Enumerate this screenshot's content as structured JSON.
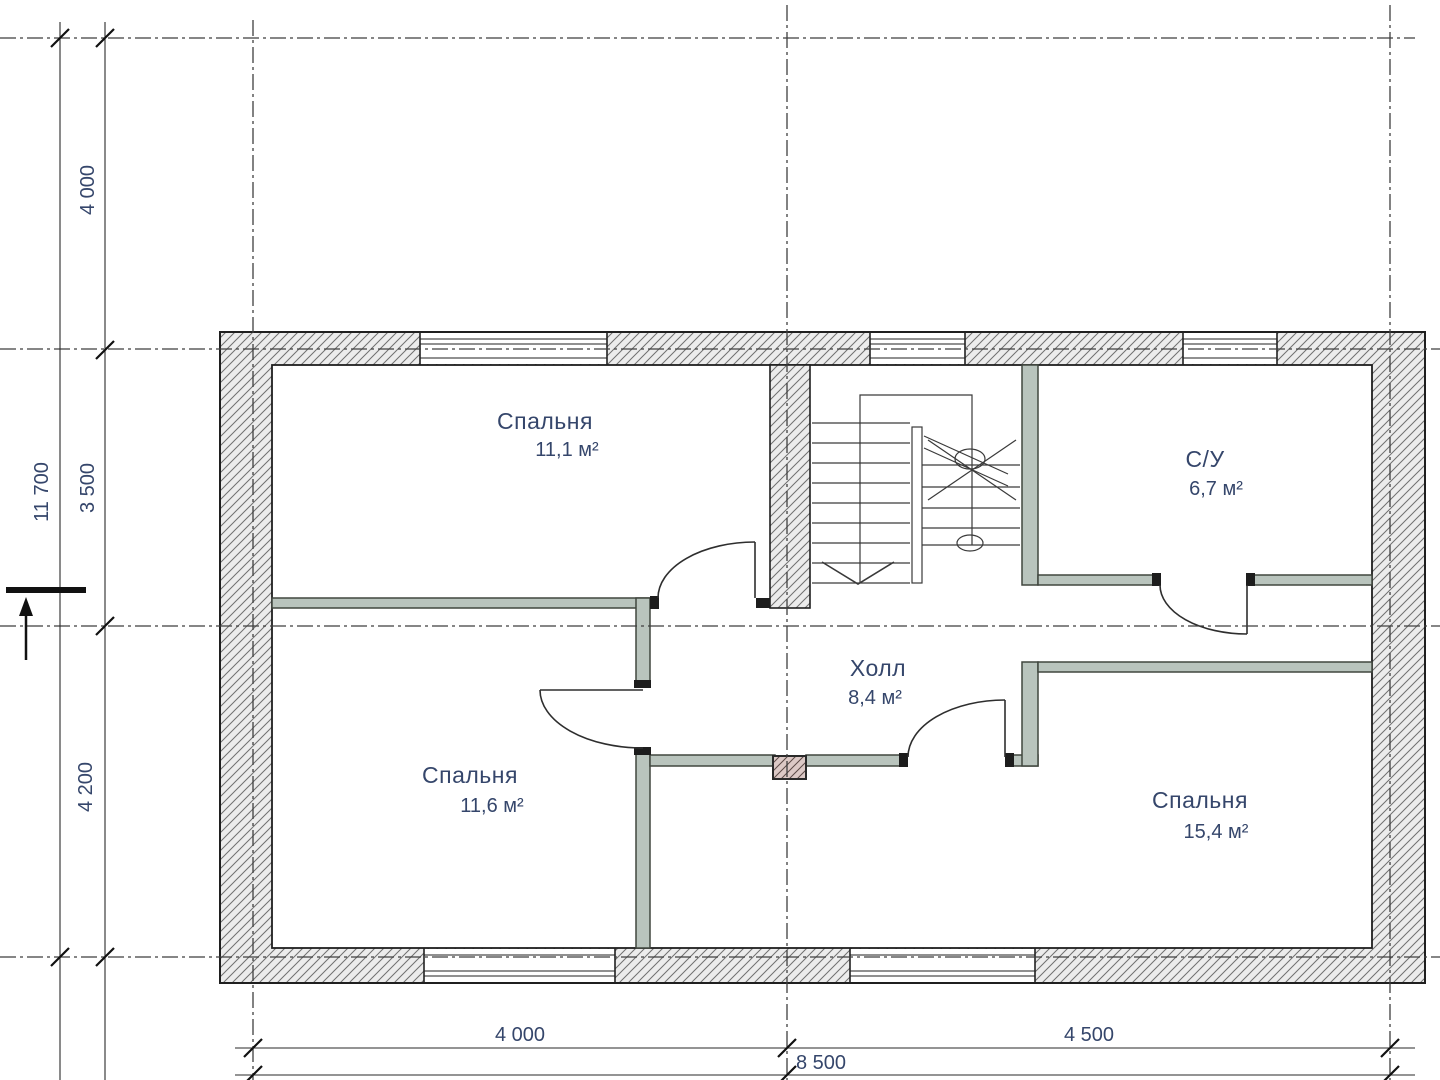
{
  "drawing_type": "floor-plan",
  "rooms": [
    {
      "id": "bedroom-1",
      "name": "Спальня",
      "area": "11,1 м²"
    },
    {
      "id": "bathroom",
      "name": "С/У",
      "area": "6,7 м²"
    },
    {
      "id": "hall",
      "name": "Холл",
      "area": "8,4 м²"
    },
    {
      "id": "bedroom-2",
      "name": "Спальня",
      "area": "11,6 м²"
    },
    {
      "id": "bedroom-3",
      "name": "Спальня",
      "area": "15,4 м²"
    }
  ],
  "dimensions": {
    "left": {
      "overall": "11 700",
      "segments": [
        "4 000",
        "3 500",
        "4 200"
      ]
    },
    "bottom": {
      "overall": "8 500",
      "segments": [
        "4 000",
        "4 500"
      ]
    }
  },
  "colors": {
    "background": "#ffffff",
    "wall_fill": "#ececec",
    "wall_hatch_line": "#707070",
    "wall_outline": "#1f1f1f",
    "partition_fill": "#b9c4bd",
    "partition_edge": "#40463f",
    "flue_fill": "#dcc9c6",
    "flue_hatch_line": "#5c4a47",
    "grid_line": "#3f3f3f",
    "drawing_line": "#2e2e2e",
    "label_text": "#35466b"
  }
}
